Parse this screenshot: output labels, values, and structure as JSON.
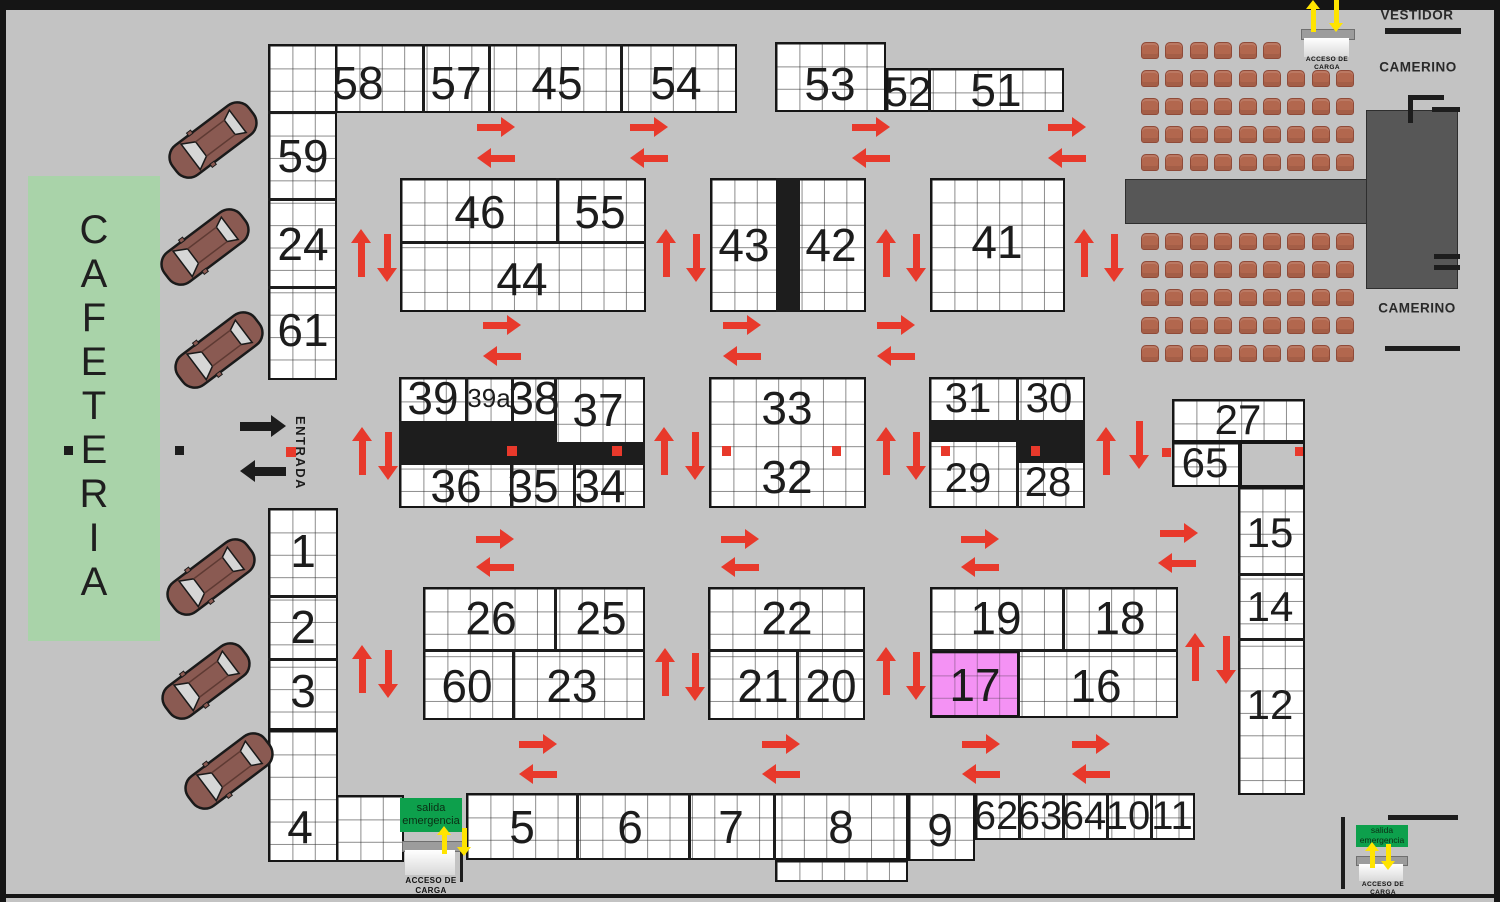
{
  "labels": {
    "cafeteria": "CAFETERIA",
    "entrada": "ENTRADA",
    "vestidor": "VESTIDOR",
    "camerino_top": "CAMERINO",
    "camerino_bottom": "CAMERINO"
  },
  "signs": {
    "acceso_line1": "ACCESO DE",
    "acceso_line2": "CARGA",
    "salida_line1": "salida",
    "salida_line2": "emergencia"
  },
  "colors": {
    "red": "#e8392b",
    "yellow": "#ffe400",
    "black": "#1d1d1d",
    "cafeteria_green": "#a9d3a9",
    "exit_green": "#0da04c",
    "pink": "#f492f4",
    "chair": "#b2674e",
    "stage": "#575757",
    "car_body": "#8a5a52"
  },
  "booth_labels": [
    {
      "t": "58",
      "x": 358,
      "y": 83
    },
    {
      "t": "57",
      "x": 456,
      "y": 83
    },
    {
      "t": "45",
      "x": 557,
      "y": 83
    },
    {
      "t": "54",
      "x": 676,
      "y": 83
    },
    {
      "t": "53",
      "x": 830,
      "y": 84
    },
    {
      "t": "52",
      "x": 908,
      "y": 92,
      "s": 42
    },
    {
      "t": "51",
      "x": 996,
      "y": 90
    },
    {
      "t": "59",
      "x": 303,
      "y": 156
    },
    {
      "t": "24",
      "x": 303,
      "y": 244
    },
    {
      "t": "61",
      "x": 303,
      "y": 330
    },
    {
      "t": "46",
      "x": 480,
      "y": 212
    },
    {
      "t": "55",
      "x": 600,
      "y": 212
    },
    {
      "t": "44",
      "x": 522,
      "y": 279
    },
    {
      "t": "43",
      "x": 744,
      "y": 245
    },
    {
      "t": "42",
      "x": 831,
      "y": 245
    },
    {
      "t": "41",
      "x": 997,
      "y": 242
    },
    {
      "t": "39",
      "x": 433,
      "y": 398
    },
    {
      "t": "39a",
      "x": 489,
      "y": 398,
      "s": 26
    },
    {
      "t": "38",
      "x": 534,
      "y": 398
    },
    {
      "t": "37",
      "x": 598,
      "y": 410
    },
    {
      "t": "36",
      "x": 456,
      "y": 486
    },
    {
      "t": "35",
      "x": 533,
      "y": 486
    },
    {
      "t": "34",
      "x": 600,
      "y": 486
    },
    {
      "t": "33",
      "x": 787,
      "y": 408
    },
    {
      "t": "32",
      "x": 787,
      "y": 477
    },
    {
      "t": "31",
      "x": 968,
      "y": 398,
      "s": 42
    },
    {
      "t": "30",
      "x": 1049,
      "y": 398,
      "s": 42
    },
    {
      "t": "29",
      "x": 968,
      "y": 478,
      "s": 42
    },
    {
      "t": "28",
      "x": 1048,
      "y": 482,
      "s": 42
    },
    {
      "t": "27",
      "x": 1238,
      "y": 420,
      "s": 42
    },
    {
      "t": "65",
      "x": 1205,
      "y": 463,
      "s": 42
    },
    {
      "t": "15",
      "x": 1270,
      "y": 533,
      "s": 42
    },
    {
      "t": "14",
      "x": 1270,
      "y": 607,
      "s": 42
    },
    {
      "t": "12",
      "x": 1270,
      "y": 705,
      "s": 42
    },
    {
      "t": "26",
      "x": 491,
      "y": 618
    },
    {
      "t": "25",
      "x": 601,
      "y": 618
    },
    {
      "t": "60",
      "x": 467,
      "y": 686
    },
    {
      "t": "23",
      "x": 572,
      "y": 686
    },
    {
      "t": "22",
      "x": 787,
      "y": 618
    },
    {
      "t": "21",
      "x": 763,
      "y": 686
    },
    {
      "t": "20",
      "x": 831,
      "y": 686
    },
    {
      "t": "19",
      "x": 996,
      "y": 618
    },
    {
      "t": "18",
      "x": 1120,
      "y": 618
    },
    {
      "t": "17",
      "x": 975,
      "y": 685
    },
    {
      "t": "16",
      "x": 1096,
      "y": 686
    },
    {
      "t": "1",
      "x": 303,
      "y": 551
    },
    {
      "t": "2",
      "x": 303,
      "y": 627
    },
    {
      "t": "3",
      "x": 303,
      "y": 691
    },
    {
      "t": "4",
      "x": 300,
      "y": 827
    },
    {
      "t": "5",
      "x": 522,
      "y": 827
    },
    {
      "t": "6",
      "x": 630,
      "y": 827
    },
    {
      "t": "7",
      "x": 731,
      "y": 827
    },
    {
      "t": "8",
      "x": 841,
      "y": 827
    },
    {
      "t": "9",
      "x": 940,
      "y": 830
    },
    {
      "t": "62",
      "x": 996,
      "y": 816,
      "s": 40
    },
    {
      "t": "63",
      "x": 1040,
      "y": 816,
      "s": 40
    },
    {
      "t": "64",
      "x": 1084,
      "y": 816,
      "s": 40
    },
    {
      "t": "10",
      "x": 1128,
      "y": 816,
      "s": 40
    },
    {
      "t": "11",
      "x": 1172,
      "y": 816,
      "s": 40
    }
  ],
  "blocks": [
    [
      335,
      44,
      402,
      69
    ],
    [
      268,
      44,
      69,
      336
    ],
    [
      775,
      42,
      111,
      70
    ],
    [
      886,
      68,
      178,
      44
    ],
    [
      400,
      178,
      246,
      134
    ],
    [
      710,
      178,
      156,
      134
    ],
    [
      930,
      178,
      135,
      134
    ],
    [
      399,
      377,
      246,
      131
    ],
    [
      709,
      377,
      157,
      131
    ],
    [
      929,
      377,
      156,
      131
    ],
    [
      1172,
      399,
      133,
      43
    ],
    [
      1172,
      442,
      68,
      45
    ],
    [
      1238,
      487,
      67,
      308
    ],
    [
      423,
      587,
      222,
      133
    ],
    [
      708,
      587,
      157,
      133
    ],
    [
      930,
      587,
      248,
      131
    ],
    [
      268,
      508,
      70,
      222
    ],
    [
      268,
      730,
      70,
      132
    ],
    [
      336,
      795,
      68,
      67
    ],
    [
      466,
      793,
      442,
      67
    ],
    [
      908,
      793,
      67,
      68
    ],
    [
      975,
      793,
      220,
      47
    ],
    [
      775,
      860,
      133,
      22
    ]
  ],
  "gray_gap": [
    1240,
    442,
    65,
    45
  ],
  "pink_booth": [
    930,
    651,
    89,
    66
  ],
  "walls": [
    [
      422,
      44,
      3,
      69
    ],
    [
      488,
      44,
      3,
      69
    ],
    [
      620,
      44,
      3,
      69
    ],
    [
      268,
      111,
      69,
      3
    ],
    [
      268,
      198,
      69,
      3
    ],
    [
      268,
      286,
      69,
      3
    ],
    [
      928,
      68,
      3,
      44
    ],
    [
      556,
      178,
      3,
      66
    ],
    [
      400,
      241,
      246,
      3
    ],
    [
      776,
      178,
      24,
      134
    ],
    [
      465,
      377,
      3,
      46
    ],
    [
      511,
      377,
      3,
      46
    ],
    [
      554,
      377,
      3,
      46
    ],
    [
      399,
      421,
      158,
      44
    ],
    [
      557,
      442,
      88,
      23
    ],
    [
      510,
      465,
      3,
      43
    ],
    [
      573,
      465,
      3,
      43
    ],
    [
      1016,
      377,
      3,
      44
    ],
    [
      929,
      420,
      156,
      22
    ],
    [
      1016,
      442,
      69,
      21
    ],
    [
      1016,
      463,
      3,
      45
    ],
    [
      1238,
      573,
      67,
      3
    ],
    [
      1238,
      638,
      67,
      3
    ],
    [
      423,
      649,
      222,
      3
    ],
    [
      554,
      587,
      3,
      62
    ],
    [
      512,
      652,
      3,
      68
    ],
    [
      708,
      649,
      157,
      3
    ],
    [
      796,
      652,
      3,
      68
    ],
    [
      930,
      649,
      248,
      3
    ],
    [
      1062,
      587,
      3,
      62
    ],
    [
      1017,
      651,
      3,
      67
    ],
    [
      268,
      595,
      70,
      3
    ],
    [
      268,
      658,
      70,
      3
    ],
    [
      576,
      793,
      3,
      67
    ],
    [
      688,
      793,
      3,
      67
    ],
    [
      773,
      793,
      3,
      67
    ],
    [
      1018,
      793,
      3,
      47
    ],
    [
      1062,
      793,
      3,
      47
    ],
    [
      1106,
      793,
      3,
      47
    ],
    [
      1150,
      793,
      3,
      47
    ]
  ],
  "red_squares": [
    [
      507,
      446,
      10,
      10
    ],
    [
      612,
      446,
      10,
      10
    ],
    [
      722,
      446,
      9,
      10
    ],
    [
      832,
      446,
      9,
      10
    ],
    [
      941,
      446,
      9,
      10
    ],
    [
      1031,
      446,
      9,
      10
    ],
    [
      1162,
      448,
      9,
      9
    ],
    [
      1295,
      447,
      8,
      9
    ],
    [
      286,
      447,
      10,
      10
    ]
  ],
  "black_squares": [
    [
      64,
      446,
      9,
      9
    ],
    [
      175,
      446,
      9,
      9
    ]
  ],
  "lines": [
    [
      1385,
      28,
      76,
      6
    ],
    [
      1385,
      346,
      75,
      5
    ],
    [
      1408,
      95,
      36,
      5
    ],
    [
      1408,
      95,
      5,
      28
    ],
    [
      1432,
      107,
      28,
      5
    ],
    [
      1434,
      254,
      26,
      5
    ],
    [
      1434,
      265,
      26,
      5
    ],
    [
      1341,
      817,
      4,
      72
    ],
    [
      1388,
      815,
      70,
      5
    ],
    [
      460,
      851,
      3,
      31
    ]
  ],
  "stage": {
    "bar": [
      1125,
      179,
      241,
      43
    ],
    "tower": [
      1366,
      110,
      90,
      177
    ]
  },
  "chairs": {
    "col_x0": 1141,
    "col_step": 24.4,
    "w": 16,
    "h": 15,
    "groups": [
      {
        "rows_y": [
          42,
          70,
          98,
          126,
          154
        ],
        "counts": [
          6,
          9,
          9,
          9,
          9
        ]
      },
      {
        "rows_y": [
          233,
          261,
          289,
          317,
          345
        ],
        "counts": [
          9,
          9,
          9,
          9,
          9
        ]
      }
    ]
  },
  "cars": [
    {
      "x": 213,
      "y": 140
    },
    {
      "x": 205,
      "y": 247
    },
    {
      "x": 219,
      "y": 350
    },
    {
      "x": 211,
      "y": 577
    },
    {
      "x": 206,
      "y": 681
    },
    {
      "x": 229,
      "y": 771
    }
  ],
  "car_rotation_deg": -37,
  "arrows": {
    "red_h_len": 38,
    "red_v_len": 48,
    "red": [
      [
        "r",
        477,
        117,
        38
      ],
      [
        "l",
        477,
        148,
        38
      ],
      [
        "r",
        630,
        117,
        38
      ],
      [
        "l",
        630,
        148,
        38
      ],
      [
        "r",
        852,
        117,
        38
      ],
      [
        "l",
        852,
        148,
        38
      ],
      [
        "r",
        1048,
        117,
        38
      ],
      [
        "l",
        1048,
        148,
        38
      ],
      [
        "r",
        483,
        315,
        38
      ],
      [
        "l",
        483,
        346,
        38
      ],
      [
        "r",
        723,
        315,
        38
      ],
      [
        "l",
        723,
        346,
        38
      ],
      [
        "r",
        877,
        315,
        38
      ],
      [
        "l",
        877,
        346,
        38
      ],
      [
        "r",
        476,
        529,
        38
      ],
      [
        "l",
        476,
        557,
        38
      ],
      [
        "r",
        721,
        529,
        38
      ],
      [
        "l",
        721,
        557,
        38
      ],
      [
        "r",
        961,
        529,
        38
      ],
      [
        "l",
        961,
        557,
        38
      ],
      [
        "r",
        1160,
        523,
        38
      ],
      [
        "l",
        1158,
        553,
        38
      ],
      [
        "r",
        519,
        734,
        38
      ],
      [
        "l",
        519,
        764,
        38
      ],
      [
        "r",
        762,
        734,
        38
      ],
      [
        "l",
        762,
        764,
        38
      ],
      [
        "r",
        962,
        734,
        38
      ],
      [
        "l",
        962,
        764,
        38
      ],
      [
        "r",
        1072,
        734,
        38
      ],
      [
        "l",
        1072,
        764,
        38
      ],
      [
        "u",
        351,
        229,
        48
      ],
      [
        "d",
        377,
        234,
        48
      ],
      [
        "u",
        656,
        229,
        48
      ],
      [
        "d",
        686,
        234,
        48
      ],
      [
        "u",
        876,
        229,
        48
      ],
      [
        "d",
        906,
        234,
        48
      ],
      [
        "u",
        1074,
        229,
        48
      ],
      [
        "d",
        1104,
        234,
        48
      ],
      [
        "u",
        352,
        427,
        48
      ],
      [
        "d",
        378,
        432,
        48
      ],
      [
        "u",
        654,
        427,
        48
      ],
      [
        "d",
        685,
        432,
        48
      ],
      [
        "u",
        876,
        427,
        48
      ],
      [
        "d",
        906,
        432,
        48
      ],
      [
        "u",
        1096,
        427,
        48
      ],
      [
        "d",
        1129,
        421,
        48
      ],
      [
        "u",
        352,
        645,
        48
      ],
      [
        "d",
        378,
        650,
        48
      ],
      [
        "u",
        655,
        648,
        48
      ],
      [
        "d",
        685,
        653,
        48
      ],
      [
        "u",
        876,
        647,
        48
      ],
      [
        "d",
        906,
        652,
        48
      ],
      [
        "u",
        1185,
        633,
        48
      ],
      [
        "d",
        1216,
        636,
        48
      ]
    ],
    "yellow": [
      [
        "u",
        1306,
        0,
        32
      ],
      [
        "d",
        1329,
        0,
        32
      ],
      [
        "u",
        437,
        826,
        28
      ],
      [
        "d",
        457,
        828,
        28
      ],
      [
        "u",
        1365,
        842,
        26
      ],
      [
        "d",
        1381,
        844,
        26
      ]
    ],
    "black_thin": [
      [
        "u",
        1310,
        33,
        21
      ],
      [
        "u",
        1335,
        33,
        21
      ],
      [
        "u",
        412,
        850,
        24
      ],
      [
        "u",
        437,
        850,
        24
      ],
      [
        "u",
        1363,
        862,
        18
      ],
      [
        "u",
        1385,
        862,
        18
      ]
    ],
    "black_big": [
      [
        "r",
        240,
        415,
        46
      ],
      [
        "l",
        240,
        460,
        46
      ]
    ]
  },
  "doors": [
    {
      "bar": [
        1301,
        29,
        52,
        9
      ],
      "door": [
        1304,
        38,
        45,
        19
      ],
      "label_x": 1327,
      "label_y": 56,
      "fs": 6.5
    },
    {
      "bar": [
        402,
        841,
        60,
        9
      ],
      "door": [
        405,
        850,
        50,
        25
      ],
      "label_x": 431,
      "label_y": 876,
      "fs": 8
    },
    {
      "bar": [
        1356,
        856,
        50,
        8
      ],
      "door": [
        1359,
        864,
        44,
        17
      ],
      "label_x": 1383,
      "label_y": 881,
      "fs": 6.5
    }
  ],
  "green_signs": [
    {
      "rect": [
        400,
        798,
        62,
        34
      ],
      "fs": 11
    },
    {
      "rect": [
        1356,
        825,
        52,
        22
      ],
      "fs": 8.5
    }
  ],
  "cafeteria_rect": [
    28,
    176,
    132,
    465
  ],
  "cafeteria_letter_y0": 230,
  "cafeteria_letter_step": 44,
  "cafeteria_x": 92,
  "room_label_pos": {
    "vestidor": [
      1417,
      15
    ],
    "camerino_top": [
      1418,
      67
    ],
    "camerino_bottom": [
      1417,
      308
    ]
  },
  "entrada_pos": [
    293,
    416
  ],
  "frame": {
    "top": [
      0,
      0,
      1500,
      10
    ],
    "left": [
      0,
      0,
      6,
      902
    ],
    "right": [
      1494,
      0,
      6,
      902
    ],
    "bottom": [
      0,
      894,
      1500,
      4
    ]
  }
}
